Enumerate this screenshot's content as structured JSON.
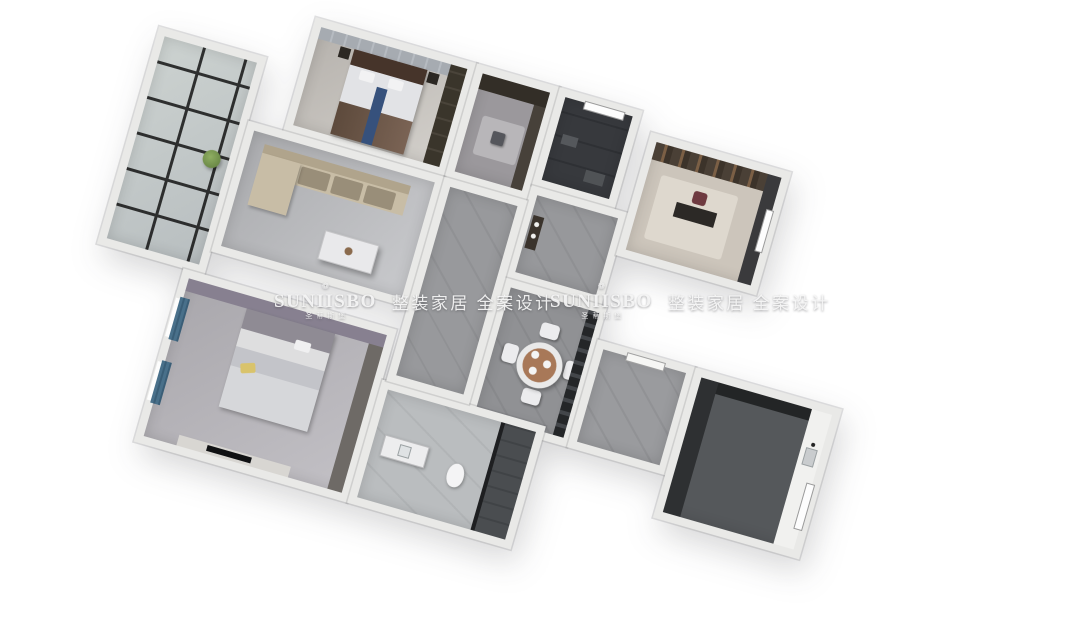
{
  "page": {
    "background_color": "#ffffff"
  },
  "watermarks": [
    {
      "crown_glyph": "❁",
      "brand": "SUNIISBO",
      "brand_cn": "圣蒂斯堡",
      "tagline": "整装家居 全案设计"
    },
    {
      "crown_glyph": "❁",
      "brand": "SUNIISBO",
      "brand_cn": "圣蒂斯堡",
      "tagline": "整装家居 全案设计"
    }
  ],
  "scene": {
    "type": "3d-birdseye-floorplan-render",
    "description": "Photorealistic dollhouse-style top view of a three-bedroom apartment, rotated clockwise on a white background",
    "rotation_deg": 16,
    "rooms": [
      "balcony",
      "living-room",
      "master-bedroom",
      "dressing-area",
      "master-bathroom",
      "foyer",
      "study",
      "dining-room",
      "entry-hall",
      "kitchen",
      "second-bedroom",
      "bathroom",
      "hallway"
    ],
    "colors": {
      "wall": "#e9e9e7",
      "floor_marble_gray": "#98999c",
      "floor_dark_tile": "#37393d",
      "sofa_beige": "#c8bda6",
      "bed_headboard_brown": "#46342a",
      "bed_runner_blue": "#36517c",
      "curtain_teal": "#49708a",
      "pillow_yellow": "#d9c36b",
      "dining_wood": "#a87858",
      "partition_black": "#242628",
      "balcony_grid_black": "#141414",
      "plant_green": "#7fa05a",
      "counter_white": "#f1f1ef"
    }
  }
}
